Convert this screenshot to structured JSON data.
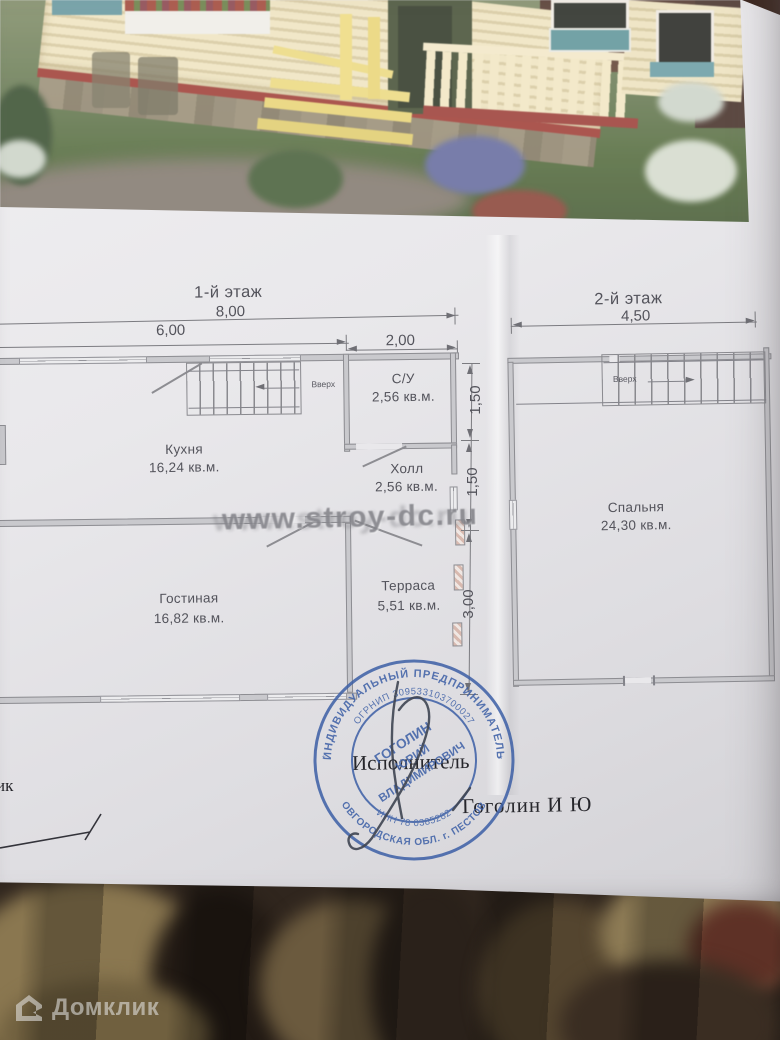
{
  "document": {
    "floor1": {
      "title": "1-й этаж",
      "dims": {
        "total": "8,00",
        "left": "6,00",
        "right": "2,00",
        "v1": "1,50",
        "v2": "1,50",
        "v3": "3,00"
      },
      "stairs_label": "Вверх",
      "rooms": {
        "kitchen": {
          "name": "Кухня",
          "area": "16,24 кв.м."
        },
        "bathroom": {
          "name": "С/У",
          "area": "2,56 кв.м."
        },
        "hall": {
          "name": "Холл",
          "area": "2,56 кв.м."
        },
        "living_room": {
          "name": "Гостиная",
          "area": "16,82 кв.м."
        },
        "terrace": {
          "name": "Терраса",
          "area": "5,51 кв.м."
        }
      }
    },
    "floor2": {
      "title": "2-й этаж",
      "dims": {
        "total": "4,50"
      },
      "stairs_label": "Вверх",
      "rooms": {
        "bedroom": {
          "name": "Спальня",
          "area": "24,30 кв.м."
        }
      }
    },
    "watermark": "www.stroy-dc.ru",
    "signature_block": {
      "left_partial_label": "ик",
      "executor_label": "Исполнитель",
      "executor_name": "Гоголин И Ю"
    },
    "stamp": {
      "color": "#3c5fa6",
      "outer_top": "ИНДИВИДУАЛЬНЫЙ ПРЕДПРИНИМАТЕЛЬ",
      "outer_bottom": "НОВГОРОДСКАЯ ОБЛ. г. ПЕСТОВО",
      "inner_top": "ОГРНИП 309533103700027",
      "inner_bottom": "ИНН 78 0385282",
      "name_line1": "ГОГОЛИН",
      "name_line2": "ЮРИЙ",
      "name_line3": "ВЛАДИМИРОВИЧ"
    }
  },
  "overlay": {
    "brand": "Домклик"
  }
}
